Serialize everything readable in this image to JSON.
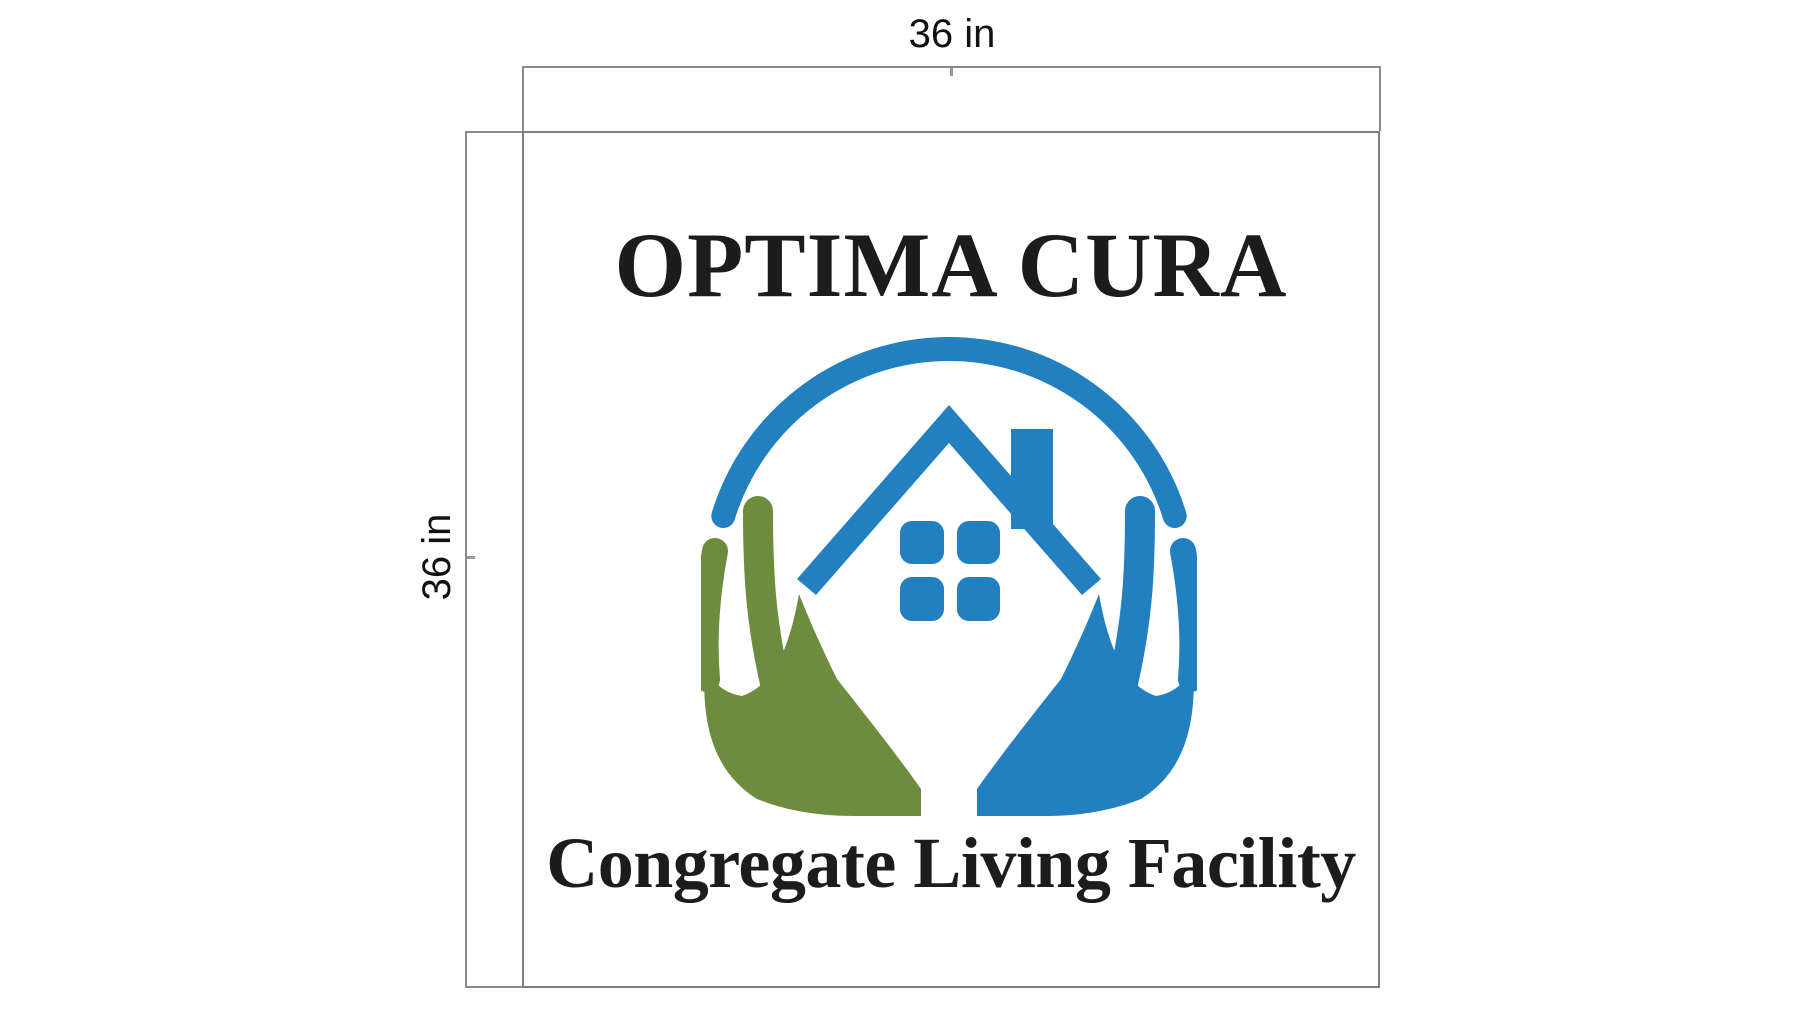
{
  "page": {
    "background": "#ffffff"
  },
  "rulers": {
    "top": {
      "label": "36 in"
    },
    "left": {
      "label": "36 in"
    },
    "line_color": "#8a8a8a",
    "label_color": "#111111"
  },
  "canvas": {
    "border_color": "#7e7e7e",
    "background": "#ffffff"
  },
  "sign": {
    "title": "OPTIMA CURA",
    "subtitle": "Congregate Living Facility",
    "text_color": "#1c1c1c",
    "logo": {
      "blue": "#2280c0",
      "green": "#6e8c3e"
    }
  }
}
